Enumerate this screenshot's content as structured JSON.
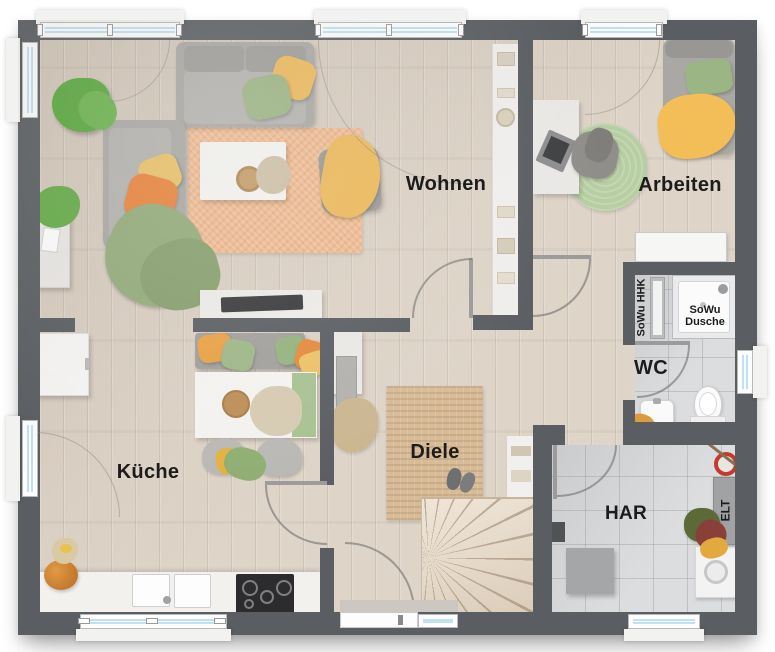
{
  "floorplan": {
    "title": "Erdgeschoss Grundriss",
    "rooms": {
      "wohnen": {
        "label": "Wohnen"
      },
      "arbeiten": {
        "label": "Arbeiten"
      },
      "kueche": {
        "label": "Küche"
      },
      "diele": {
        "label": "Diele"
      },
      "wc": {
        "label": "WC"
      },
      "har": {
        "label": "HAR"
      }
    },
    "annotations": {
      "shower": {
        "label": "SoWu Dusche"
      },
      "heater": {
        "label": "SoWu HHK"
      },
      "electrical": {
        "label": "ELT"
      }
    },
    "colors": {
      "wall": "#5a5e62",
      "wood": "#dbd0c3",
      "tile": "#d7d8da",
      "glass": "#bfe2f2",
      "rug_living": "#efb98e",
      "rug_jute": "#d8bb97",
      "rug_work": "#b7cda2",
      "accent_yellow": "#ecb95b",
      "accent_orange": "#e8843b",
      "accent_green": "#9cb584",
      "accent_red": "#c43a2e",
      "label_text": "#1c1c1c"
    }
  }
}
